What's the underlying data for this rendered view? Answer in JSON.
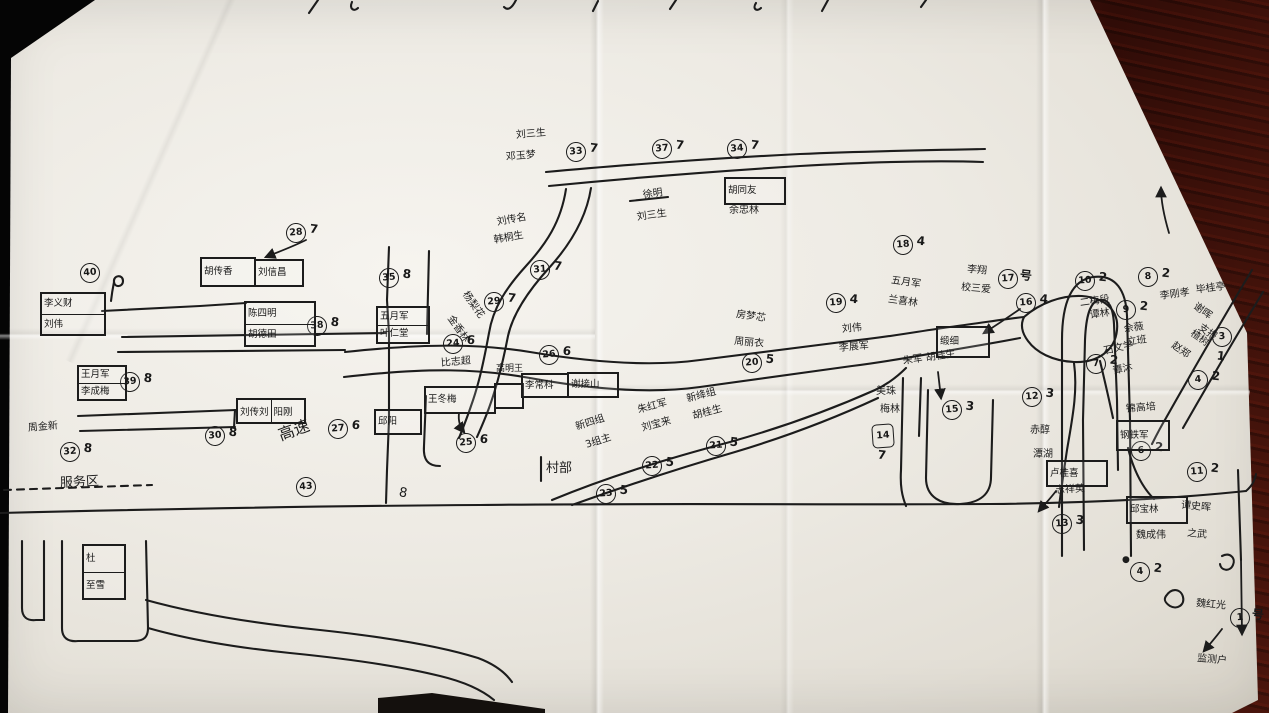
{
  "scene": {
    "description": "hand-drawn village household sketch map on creased paper",
    "ink_color": "#1c1c1c",
    "paper_color": "#edeae3",
    "table_color": "#4a150c",
    "legend": {
      "name": "魏红光",
      "number": "1",
      "suffix": "号",
      "target": "监测户"
    }
  },
  "map": {
    "circles": [
      {
        "n": "33",
        "g": "7",
        "x": 576,
        "y": 152
      },
      {
        "n": "37",
        "g": "7",
        "x": 662,
        "y": 149
      },
      {
        "n": "34",
        "g": "7",
        "x": 737,
        "y": 149
      },
      {
        "n": "28",
        "g": "7",
        "x": 296,
        "y": 233
      },
      {
        "n": "31",
        "g": "7",
        "x": 540,
        "y": 270
      },
      {
        "n": "29",
        "g": "7",
        "x": 494,
        "y": 302
      },
      {
        "n": "35",
        "g": "8",
        "x": 389,
        "y": 278
      },
      {
        "n": "38",
        "g": "8",
        "x": 317,
        "y": 326
      },
      {
        "n": "40",
        "g": "",
        "x": 90,
        "y": 273
      },
      {
        "n": "39",
        "g": "8",
        "x": 130,
        "y": 382
      },
      {
        "n": "32",
        "g": "8",
        "x": 70,
        "y": 452
      },
      {
        "n": "30",
        "g": "8",
        "x": 215,
        "y": 436
      },
      {
        "n": "43",
        "g": "",
        "x": 306,
        "y": 487
      },
      {
        "n": "24",
        "g": "6",
        "x": 453,
        "y": 344
      },
      {
        "n": "26",
        "g": "6",
        "x": 549,
        "y": 355
      },
      {
        "n": "25",
        "g": "6",
        "x": 466,
        "y": 443
      },
      {
        "n": "27",
        "g": "6",
        "x": 338,
        "y": 429
      },
      {
        "n": "23",
        "g": "5",
        "x": 606,
        "y": 494
      },
      {
        "n": "22",
        "g": "5",
        "x": 652,
        "y": 466
      },
      {
        "n": "21",
        "g": "5",
        "x": 716,
        "y": 446
      },
      {
        "n": "20",
        "g": "5",
        "x": 752,
        "y": 363
      },
      {
        "n": "18",
        "g": "4",
        "x": 903,
        "y": 245
      },
      {
        "n": "19",
        "g": "4",
        "x": 836,
        "y": 303
      },
      {
        "n": "17",
        "g": "号",
        "x": 1008,
        "y": 279
      },
      {
        "n": "16",
        "g": "4",
        "x": 1026,
        "y": 303
      },
      {
        "n": "15",
        "g": "3",
        "x": 952,
        "y": 410
      },
      {
        "n": "14",
        "g": "7",
        "x": 883,
        "y": 436,
        "sq": 1,
        "gb": 1
      },
      {
        "n": "12",
        "g": "3",
        "x": 1032,
        "y": 397
      },
      {
        "n": "13",
        "g": "3",
        "x": 1062,
        "y": 524
      },
      {
        "n": "10",
        "g": "2",
        "x": 1085,
        "y": 281
      },
      {
        "n": "9",
        "g": "2",
        "x": 1126,
        "y": 310
      },
      {
        "n": "8",
        "g": "2",
        "x": 1148,
        "y": 277
      },
      {
        "n": "7",
        "g": "2",
        "x": 1096,
        "y": 364
      },
      {
        "n": "3",
        "g": "1",
        "x": 1222,
        "y": 337,
        "gb": 1
      },
      {
        "n": "4",
        "g": "2",
        "x": 1198,
        "y": 380
      },
      {
        "n": "6",
        "g": "2",
        "x": 1141,
        "y": 451
      },
      {
        "n": "11",
        "g": "2",
        "x": 1197,
        "y": 472
      },
      {
        "n": "4",
        "g": "2",
        "x": 1140,
        "y": 572
      },
      {
        "n": "1",
        "g": "号",
        "x": 1240,
        "y": 618
      }
    ],
    "boxes": [
      {
        "rows": [
          "李义财",
          "刘伟"
        ],
        "x": 40,
        "y": 292,
        "w": 62,
        "h": 40
      },
      {
        "rows": [
          "胡传香"
        ],
        "x": 200,
        "y": 257,
        "w": 52,
        "h": 26
      },
      {
        "rows": [
          "刘信昌"
        ],
        "x": 254,
        "y": 259,
        "w": 46,
        "h": 24
      },
      {
        "rows": [
          "陈四明",
          "胡德田"
        ],
        "x": 244,
        "y": 301,
        "w": 68,
        "h": 42
      },
      {
        "rows": [
          "五月军",
          "叶仁堂"
        ],
        "x": 376,
        "y": 306,
        "w": 50,
        "h": 34
      },
      {
        "rows": [
          "王月军",
          "李成梅"
        ],
        "x": 77,
        "y": 365,
        "w": 46,
        "h": 32
      },
      {
        "cols": [
          "刘传刘",
          "阳刚"
        ],
        "x": 236,
        "y": 398,
        "w": 66,
        "h": 22
      },
      {
        "rows": [
          "王冬梅"
        ],
        "x": 424,
        "y": 386,
        "w": 68,
        "h": 24
      },
      {
        "rows": [
          ""
        ],
        "x": 494,
        "y": 383,
        "w": 26,
        "h": 22
      },
      {
        "rows": [
          "李常科"
        ],
        "x": 521,
        "y": 373,
        "w": 44,
        "h": 21
      },
      {
        "rows": [
          "谢接山"
        ],
        "x": 567,
        "y": 372,
        "w": 48,
        "h": 22
      },
      {
        "rows": [
          "胡同友"
        ],
        "x": 724,
        "y": 177,
        "w": 58,
        "h": 24
      },
      {
        "rows": [
          "邱阳"
        ],
        "x": 374,
        "y": 409,
        "w": 44,
        "h": 22
      },
      {
        "rows": [
          "缎细"
        ],
        "x": 936,
        "y": 326,
        "w": 50,
        "h": 28
      },
      {
        "rows": [
          "钢铁军"
        ],
        "x": 1116,
        "y": 420,
        "w": 50,
        "h": 27
      },
      {
        "rows": [
          "卢桂喜"
        ],
        "x": 1046,
        "y": 460,
        "w": 58,
        "h": 23
      },
      {
        "rows": [
          "邱宝林"
        ],
        "x": 1126,
        "y": 496,
        "w": 58,
        "h": 24
      },
      {
        "rows": [
          "杜",
          "至雪"
        ],
        "x": 82,
        "y": 544,
        "w": 40,
        "h": 52
      }
    ],
    "labels": [
      {
        "t": "刘三生",
        "x": 516,
        "y": 131,
        "r": -5
      },
      {
        "t": "邓玉梦",
        "x": 506,
        "y": 153,
        "r": -5
      },
      {
        "t": "徐明",
        "x": 643,
        "y": 191,
        "r": -8
      },
      {
        "t": "刘三生",
        "x": 637,
        "y": 213,
        "r": -8
      },
      {
        "t": "刘传名",
        "x": 497,
        "y": 218,
        "r": -10
      },
      {
        "t": "韩桐生",
        "x": 494,
        "y": 236,
        "r": -10
      },
      {
        "t": "杨梨花",
        "x": 464,
        "y": 288,
        "r": 55
      },
      {
        "t": "金香林",
        "x": 449,
        "y": 312,
        "r": 55
      },
      {
        "t": "余忠林",
        "x": 729,
        "y": 206,
        "r": 0
      },
      {
        "t": "周金新",
        "x": 28,
        "y": 424,
        "r": -5
      },
      {
        "t": "高速",
        "x": 279,
        "y": 428,
        "r": -20,
        "s": 16
      },
      {
        "t": "高明王",
        "x": 496,
        "y": 365,
        "r": 0,
        "s": 9
      },
      {
        "t": "比志超",
        "x": 441,
        "y": 359,
        "r": -5
      },
      {
        "t": "村部",
        "x": 546,
        "y": 462,
        "r": 0,
        "s": 13
      },
      {
        "t": "新四组",
        "x": 576,
        "y": 423,
        "r": -18
      },
      {
        "t": "3组主",
        "x": 586,
        "y": 441,
        "r": -18
      },
      {
        "t": "朱红军",
        "x": 638,
        "y": 406,
        "r": -15
      },
      {
        "t": "刘宝来",
        "x": 642,
        "y": 424,
        "r": -15
      },
      {
        "t": "新绛组",
        "x": 687,
        "y": 395,
        "r": -15
      },
      {
        "t": "胡桂生",
        "x": 693,
        "y": 412,
        "r": -15
      },
      {
        "t": "房梦芯",
        "x": 736,
        "y": 310,
        "r": 8
      },
      {
        "t": "周丽衣",
        "x": 734,
        "y": 337,
        "r": 5
      },
      {
        "t": "五月军",
        "x": 891,
        "y": 276,
        "r": 8
      },
      {
        "t": "兰喜林",
        "x": 888,
        "y": 295,
        "r": 8
      },
      {
        "t": "李翔",
        "x": 967,
        "y": 265,
        "r": 5
      },
      {
        "t": "校三爱",
        "x": 961,
        "y": 283,
        "r": 5
      },
      {
        "t": "刘伟",
        "x": 842,
        "y": 325,
        "r": -5
      },
      {
        "t": "李展军",
        "x": 839,
        "y": 344,
        "r": -5
      },
      {
        "t": "朱军 胡桂生",
        "x": 903,
        "y": 357,
        "r": -8
      },
      {
        "t": "美珠",
        "x": 876,
        "y": 387,
        "r": 0
      },
      {
        "t": "梅林",
        "x": 880,
        "y": 405,
        "r": 0
      },
      {
        "t": "赤醇",
        "x": 1030,
        "y": 426,
        "r": 0
      },
      {
        "t": "潭湖",
        "x": 1033,
        "y": 450,
        "r": 0
      },
      {
        "t": "石文学",
        "x": 1104,
        "y": 347,
        "r": -12
      },
      {
        "t": "谭沐",
        "x": 1113,
        "y": 367,
        "r": -12
      },
      {
        "t": "二梅段",
        "x": 1080,
        "y": 299,
        "r": -8
      },
      {
        "t": "谭林",
        "x": 1090,
        "y": 311,
        "r": -8
      },
      {
        "t": "佘薇",
        "x": 1124,
        "y": 325,
        "r": -8
      },
      {
        "t": "立班",
        "x": 1127,
        "y": 338,
        "r": -8
      },
      {
        "t": "李刚孝",
        "x": 1160,
        "y": 292,
        "r": -8
      },
      {
        "t": "毕桂亭",
        "x": 1196,
        "y": 286,
        "r": -8
      },
      {
        "t": "谢晖",
        "x": 1194,
        "y": 301,
        "r": 35
      },
      {
        "t": "支报",
        "x": 1199,
        "y": 322,
        "r": 35
      },
      {
        "t": "赵郑",
        "x": 1172,
        "y": 340,
        "r": 35
      },
      {
        "t": "楂树",
        "x": 1191,
        "y": 328,
        "r": 35
      },
      {
        "t": "锦高培",
        "x": 1126,
        "y": 405,
        "r": -5
      },
      {
        "t": "魏成伟",
        "x": 1136,
        "y": 531,
        "r": 0
      },
      {
        "t": "谭史晖",
        "x": 1181,
        "y": 501,
        "r": 5
      },
      {
        "t": "之武",
        "x": 1187,
        "y": 529,
        "r": 5
      },
      {
        "t": "志祥英",
        "x": 1055,
        "y": 486,
        "r": -3
      },
      {
        "t": "服务区",
        "x": 60,
        "y": 477,
        "r": -3,
        "s": 13
      },
      {
        "t": "魏红光",
        "x": 1196,
        "y": 599,
        "r": 5
      },
      {
        "t": "监测户",
        "x": 1197,
        "y": 654,
        "r": 5
      },
      {
        "t": "8",
        "x": 399,
        "y": 486,
        "r": 10,
        "s": 13
      },
      {
        "t": "●",
        "x": 1122,
        "y": 556,
        "r": 0,
        "s": 9
      }
    ],
    "roads": [
      "M546,172 C620,165 720,158 800,154 C870,151 930,150 985,149",
      "M549,186 C620,179 720,171 800,166 C870,162 930,160 983,162",
      "M566,189 C561,222 546,244 526,266 C506,288 493,308 489,333 C484,360 479,384 471,406 C467,418 463,428 459,438",
      "M591,188 C586,220 569,246 549,268 C529,290 513,313 508,336 C503,362 497,386 489,408 C485,419 481,428 477,437",
      "M389,247 L387,300 L389,334 L389,420 L387,470 L386,503",
      "M429,251 L427,334",
      "M426,396 L424,446 C423,460 428,466 440,466",
      "M102,311 L200,306 L246,303",
      "M122,337 L386,333",
      "M118,352 L345,350",
      "M78,416 L236,410",
      "M80,431 L235,427",
      "M235,410 L234,428",
      "M345,352 C430,343 480,344 530,352 C590,362 650,367 700,360 C760,352 810,346 850,341 C890,337 920,331 950,327 C980,323 1005,319 1024,317",
      "M344,377 C430,367 480,369 530,378 C590,389 650,394 700,387 C760,379 812,372 852,366 C892,361 922,355 952,350 C982,345 1005,341 1020,338",
      "M1024,317 C1040,303 1062,295 1082,296 C1106,298 1119,311 1117,330 C1115,351 1097,363 1074,362 C1052,361 1036,352 1028,341 C1022,333 1020,325 1024,317",
      "M1074,363 C1078,392 1072,420 1067,450 C1064,470 1061,490 1059,507",
      "M1100,361 C1106,386 1110,404 1113,418",
      "M1128,448 C1133,468 1141,486 1154,499",
      "M928,390 L926,478 C926,497 941,505 960,504 C980,503 991,494 991,477 L993,400",
      "M903,378 L901,470 C900,486 902,496 906,506",
      "M921,378 L919,436",
      "M552,500 C610,476 670,458 730,442 C780,428 830,410 875,390 C888,384 898,376 906,368",
      "M572,505 C625,486 680,468 735,452 C785,437 835,418 878,398",
      "M0,513 C160,509 320,506 480,505 C650,503 820,505 990,504 C1090,503 1170,499 1246,491",
      "M1246,491 C1252,486 1255,480 1256,474",
      "M1062,556 L1062,340 C1062,300 1073,280 1093,277 C1116,274 1126,291 1127,316 L1130,420 L1131,556",
      "M1084,550 L1083,420 L1085,340 C1086,316 1090,302 1099,300 C1109,298 1113,308 1114,324 L1117,400 L1118,470",
      "M1252,270 C1222,320 1192,372 1166,418 C1160,428 1156,436 1152,444",
      "M1263,292 C1235,338 1207,386 1183,428",
      "M1238,470 L1241,560",
      "M22,541 L22,608 C22,617 27,621 36,620 L44,620 L44,541",
      "M62,541 L62,628 C62,638 68,642 78,641 L134,641 C144,641 148,637 148,628 L146,541",
      "M148,628 C190,640 240,648 290,653 C350,659 400,666 440,676 C465,682 482,690 494,700",
      "M146,600 C200,615 260,624 320,630 C385,637 440,646 478,658 C494,664 505,672 512,682",
      "M1166,596 c6,-9 15,-7 17,1 c2,8 -6,13 -13,9 c-6,-4 -6,-7 -4,-10",
      "M1222,556 c8,-4 14,2 11,9 c-3,7 -12,6 -13,-1",
      "M111,301 C112,292 113,287 114,282 M114,282 c-1,-7 9,-8 9,-1 c0,6 -8,7 -9,1",
      "M630,201 L668,197",
      "M541,457 L541,481",
      "M318,0 L309,13",
      "M352,2 C349,9 354,12 358,8",
      "M516,0 C512,8 508,11 504,7",
      "M598,1 L593,11",
      "M676,0 L670,9",
      "M756,3 C752,9 757,12 761,8",
      "M828,0 L822,11",
      "M926,0 L921,7"
    ],
    "dashed": [
      "M4,490 L152,485"
    ],
    "arrows": [
      "M306,240 C292,247 278,252 266,257",
      "M1020,309 C1007,318 995,326 984,333",
      "M938,372 L941,398",
      "M459,413 C458,421 460,427 464,432",
      "M1056,491 C1050,499 1044,505 1039,511",
      "M1222,629 C1216,637 1210,644 1204,651",
      "M1169,233 C1164,216 1161,200 1161,188",
      "M1241,560 L1242,634"
    ]
  }
}
